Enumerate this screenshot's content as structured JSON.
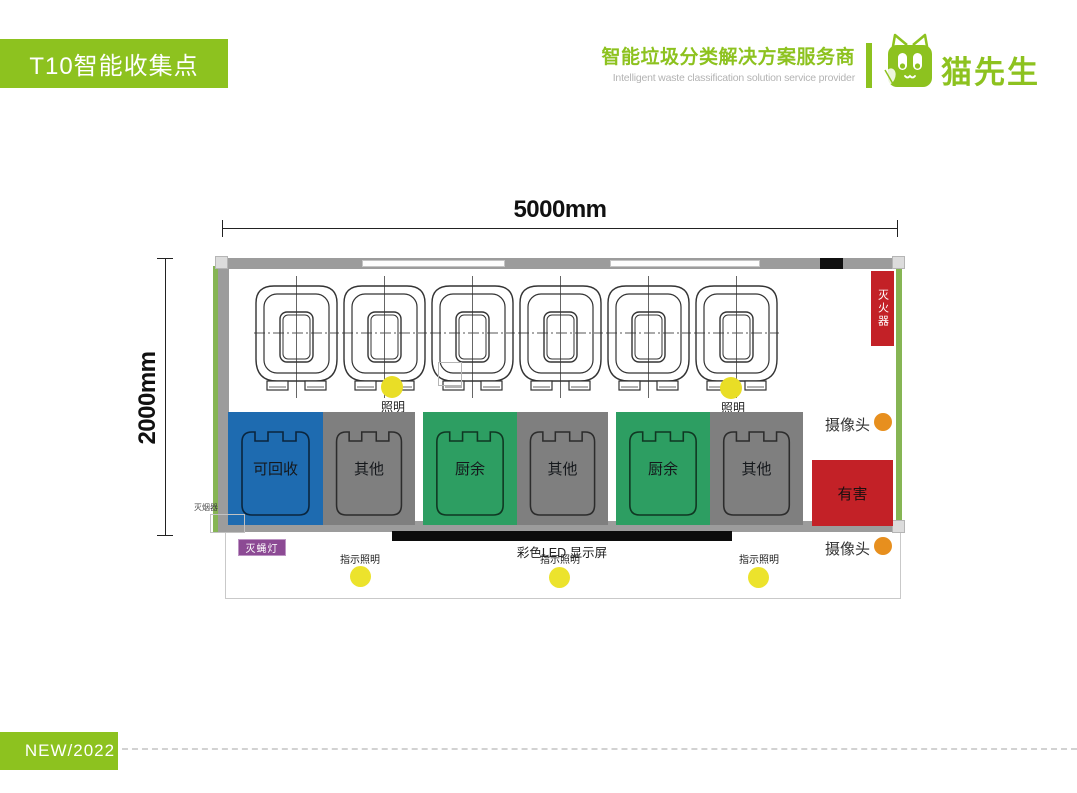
{
  "header": {
    "title": "T10智能收集点",
    "tagline_zh": "智能垃圾分类解决方案服务商",
    "tagline_en": "Intelligent waste classification solution service provider",
    "brand": "猫先生"
  },
  "colors": {
    "brand_green": "#8dc21f",
    "recyclable_blue": "#1e6bb0",
    "other_gray": "#7f7f7f",
    "kitchen_green": "#2d9e62",
    "hazard_red": "#c32127",
    "lighting_yellow": "#e9de26",
    "camera_orange": "#e78f1e",
    "fly_lamp_purple": "#8c4a94"
  },
  "diagram": {
    "dim_width": "5000mm",
    "dim_height": "2000mm",
    "bins": [
      {
        "label": "可回收",
        "color": "#1e6bb0"
      },
      {
        "label": "其他",
        "color": "#7f7f7f"
      },
      {
        "label": "厨余",
        "color": "#2d9e62"
      },
      {
        "label": "其他",
        "color": "#7f7f7f"
      },
      {
        "label": "厨余",
        "color": "#2d9e62"
      },
      {
        "label": "其他",
        "color": "#7f7f7f"
      }
    ],
    "hazard": {
      "label": "有害",
      "color": "#c32127"
    },
    "labels": {
      "lighting": "照明",
      "camera": "摄像头",
      "fire_extinguisher": "灭火器",
      "led_display": "彩色LED 显示屏",
      "fly_lamp": "灭蝇灯",
      "smoke_extinguisher": "灭烟器",
      "indicator_lighting": "指示照明"
    }
  },
  "footer": {
    "badge": "NEW/2022"
  }
}
